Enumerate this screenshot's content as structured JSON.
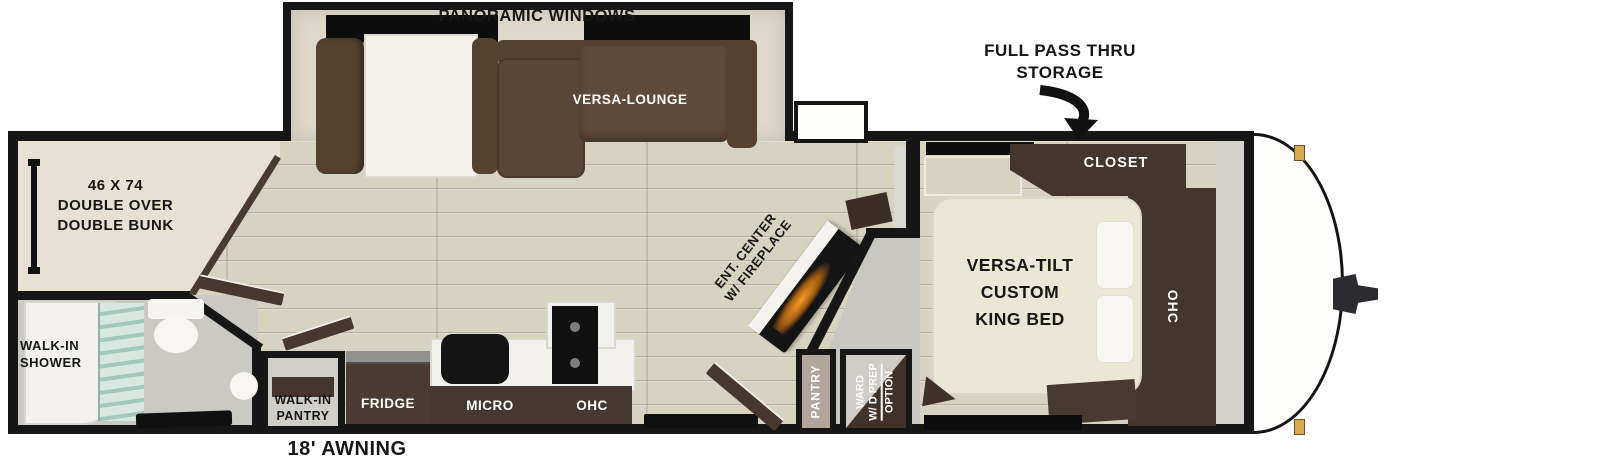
{
  "title": "Travel trailer floorplan",
  "labels": {
    "panoramic_windows": "PANORAMIC WINDOWS",
    "versa_lounge": "VERSA-LOUNGE",
    "full_pass_thru": {
      "line1": "FULL PASS THRU",
      "line2": "STORAGE"
    },
    "closet": "CLOSET",
    "bedroom_ohc": "OHC",
    "bunk": {
      "line1": "46 X 74",
      "line2": "DOUBLE OVER",
      "line3": "DOUBLE BUNK"
    },
    "king_bed": {
      "line1": "VERSA-TILT",
      "line2": "CUSTOM",
      "line3": "KING BED"
    },
    "walk_in_shower": {
      "line1": "WALK-IN",
      "line2": "SHOWER"
    },
    "walk_in_pantry": {
      "line1": "WALK-IN",
      "line2": "PANTRY"
    },
    "fridge": "FRIDGE",
    "micro": "MICRO",
    "kitchen_ohc": "OHC",
    "ent_center": {
      "line1": "ENT. CENTER",
      "line2": "W/ FIREPLACE"
    },
    "pantry": "PANTRY",
    "ward": {
      "line1": "WARD",
      "line2": "W/ D PREP",
      "line3": "OPTION"
    },
    "awning": "18' AWNING"
  },
  "colors": {
    "wall": "#161616",
    "floor_wood": "#d7d3c1",
    "room_beige": "#e6e1d2",
    "sofa_brown": "#5e4a39",
    "cabinet_brown": "#43362d",
    "bed_cream": "#ebe7d5",
    "shower_glass": "#a3c9bc",
    "fireplace_glow": "#f59b26",
    "marker_gold": "#d9a94f"
  }
}
